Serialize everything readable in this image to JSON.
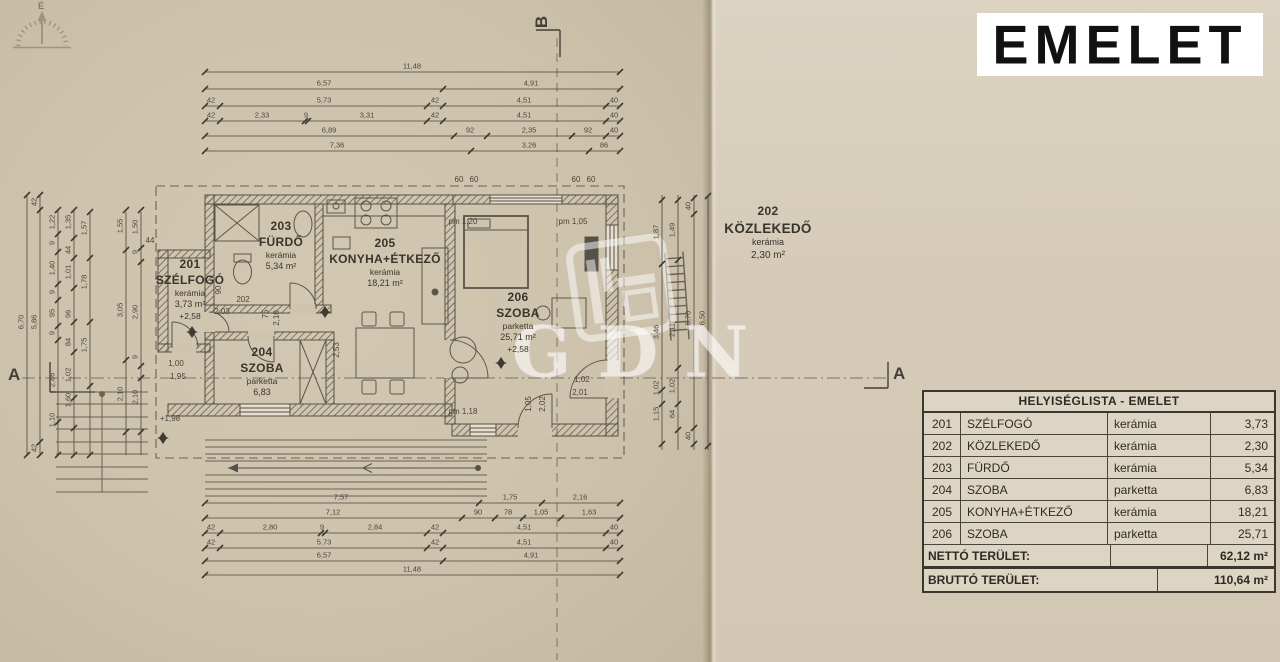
{
  "title_block": "EMELET",
  "compass": {
    "label": "É"
  },
  "section_markers": {
    "a_left": "A",
    "a_right": "A",
    "b_top": "B"
  },
  "watermark": {
    "text": "GDN"
  },
  "colors": {
    "paper_left": "#cdc2ac",
    "paper_right": "#d5cbb8",
    "ink": "#4a443b",
    "wall": "#57514a",
    "table_bg": "#ddd5c4",
    "title_bg": "#ffffff",
    "title_fg": "#111111"
  },
  "rooms": [
    {
      "number": "201",
      "name": "SZÉLFOGÓ",
      "material": "kerámia",
      "area": "3,73 m²",
      "level": "+2,58"
    },
    {
      "number": "202",
      "name": "KÖZLEKEDŐ",
      "material": "kerámia",
      "area": "2,30 m²"
    },
    {
      "number": "203",
      "name": "FÜRDŐ",
      "material": "kerámia",
      "area": "5,34 m²"
    },
    {
      "number": "204",
      "name": "SZOBA",
      "material": "parketta",
      "area": "6,83"
    },
    {
      "number": "205",
      "name": "KONYHA+ÉTKEZŐ",
      "material": "kerámia",
      "area": "18,21 m²"
    },
    {
      "number": "206",
      "name": "SZOBA",
      "material": "parketta",
      "area": "25,71 m²",
      "level": "+2,58"
    }
  ],
  "table": {
    "title": "HELYISÉGLISTA - EMELET",
    "rows": [
      {
        "num": "201",
        "name": "SZÉLFOGÓ",
        "material": "kerámia",
        "area": "3,73"
      },
      {
        "num": "202",
        "name": "KÖZLEKEDŐ",
        "material": "kerámia",
        "area": "2,30"
      },
      {
        "num": "203",
        "name": "FÜRDŐ",
        "material": "kerámia",
        "area": "5,34"
      },
      {
        "num": "204",
        "name": "SZOBA",
        "material": "parketta",
        "area": "6,83"
      },
      {
        "num": "205",
        "name": "KONYHA+ÉTKEZŐ",
        "material": "kerámia",
        "area": "18,21"
      },
      {
        "num": "206",
        "name": "SZOBA",
        "material": "parketta",
        "area": "25,71"
      }
    ],
    "netto_label": "NETTÓ TERÜLET:",
    "netto_value": "62,12 m²",
    "brutto_label": "BRUTTÓ TERÜLET:",
    "brutto_value": "110,64 m²"
  },
  "dims": {
    "top": [
      {
        "y": 72,
        "x1": 205,
        "x2": 620,
        "ticks": [
          205,
          620
        ],
        "labels": [
          {
            "t": "11,48",
            "x": 412
          }
        ]
      },
      {
        "y": 89,
        "x1": 205,
        "x2": 620,
        "ticks": [
          205,
          443,
          620
        ],
        "labels": [
          {
            "t": "6,57",
            "x": 324
          },
          {
            "t": "4,91",
            "x": 531
          }
        ]
      },
      {
        "y": 106,
        "x1": 205,
        "x2": 620,
        "ticks": [
          205,
          220,
          427,
          443,
          606,
          620
        ],
        "labels": [
          {
            "t": "42",
            "x": 211
          },
          {
            "t": "5,73",
            "x": 324
          },
          {
            "t": "42",
            "x": 435
          },
          {
            "t": "4,51",
            "x": 524
          },
          {
            "t": "40",
            "x": 614
          }
        ]
      },
      {
        "y": 121,
        "x1": 205,
        "x2": 620,
        "ticks": [
          205,
          220,
          305,
          308,
          427,
          443,
          606,
          620
        ],
        "labels": [
          {
            "t": "42",
            "x": 211
          },
          {
            "t": "2,33",
            "x": 262
          },
          {
            "t": "9",
            "x": 306
          },
          {
            "t": "3,31",
            "x": 367
          },
          {
            "t": "42",
            "x": 435
          },
          {
            "t": "4,51",
            "x": 524
          },
          {
            "t": "40",
            "x": 614
          }
        ]
      },
      {
        "y": 136,
        "x1": 205,
        "x2": 620,
        "ticks": [
          205,
          454,
          487,
          572,
          606,
          620
        ],
        "labels": [
          {
            "t": "6,89",
            "x": 329
          },
          {
            "t": "92",
            "x": 470
          },
          {
            "t": "2,35",
            "x": 529
          },
          {
            "t": "92",
            "x": 588
          },
          {
            "t": "40",
            "x": 614
          }
        ]
      },
      {
        "y": 151,
        "x1": 205,
        "x2": 620,
        "ticks": [
          205,
          471,
          589,
          620
        ],
        "labels": [
          {
            "t": "7,36",
            "x": 337
          },
          {
            "t": "3,26",
            "x": 529
          },
          {
            "t": "86",
            "x": 604
          }
        ]
      }
    ],
    "bottom": [
      {
        "y": 503,
        "x1": 205,
        "x2": 620,
        "ticks": [
          205,
          479,
          542,
          620
        ],
        "labels": [
          {
            "t": "7,57",
            "x": 341
          },
          {
            "t": "1,75",
            "x": 510
          },
          {
            "t": "2,16",
            "x": 580
          }
        ]
      },
      {
        "y": 518,
        "x1": 205,
        "x2": 620,
        "ticks": [
          205,
          462,
          495,
          523,
          561,
          620
        ],
        "labels": [
          {
            "t": "7,12",
            "x": 333
          },
          {
            "t": "90",
            "x": 478
          },
          {
            "t": "78",
            "x": 508
          },
          {
            "t": "1,05",
            "x": 541
          },
          {
            "t": "1,63",
            "x": 589
          }
        ]
      },
      {
        "y": 533,
        "x1": 205,
        "x2": 620,
        "ticks": [
          205,
          220,
          321,
          325,
          427,
          443,
          606,
          620
        ],
        "labels": [
          {
            "t": "42",
            "x": 211
          },
          {
            "t": "2,80",
            "x": 270
          },
          {
            "t": "9",
            "x": 322
          },
          {
            "t": "2,84",
            "x": 375
          },
          {
            "t": "42",
            "x": 435
          },
          {
            "t": "4,51",
            "x": 524
          },
          {
            "t": "40",
            "x": 614
          }
        ]
      },
      {
        "y": 548,
        "x1": 205,
        "x2": 620,
        "ticks": [
          205,
          220,
          427,
          443,
          606,
          620
        ],
        "labels": [
          {
            "t": "42",
            "x": 211
          },
          {
            "t": "5,73",
            "x": 324
          },
          {
            "t": "42",
            "x": 435
          },
          {
            "t": "4,51",
            "x": 524
          },
          {
            "t": "40",
            "x": 614
          }
        ]
      },
      {
        "y": 561,
        "x1": 205,
        "x2": 620,
        "ticks": [
          205,
          443,
          620
        ],
        "labels": [
          {
            "t": "6,57",
            "x": 324
          },
          {
            "t": "4,91",
            "x": 531
          }
        ]
      },
      {
        "y": 575,
        "x1": 205,
        "x2": 620,
        "ticks": [
          205,
          620
        ],
        "labels": [
          {
            "t": "11,48",
            "x": 412
          }
        ]
      }
    ],
    "left": [
      {
        "x": 27,
        "y1": 195,
        "y2": 455,
        "ticks": [
          195,
          455
        ],
        "labels": [
          {
            "t": "6,70",
            "y": 322
          }
        ]
      },
      {
        "x": 40,
        "y1": 195,
        "y2": 455,
        "ticks": [
          195,
          210,
          442,
          455
        ],
        "labels": [
          {
            "t": "42",
            "y": 202
          },
          {
            "t": "5,86",
            "y": 322
          },
          {
            "t": "42",
            "y": 448
          }
        ]
      },
      {
        "x": 58,
        "y1": 210,
        "y2": 455,
        "ticks": [
          210,
          234,
          252,
          284,
          300,
          326,
          340,
          422,
          455
        ],
        "labels": [
          {
            "t": "1,22",
            "y": 222
          },
          {
            "t": "9",
            "y": 243
          },
          {
            "t": "1,40",
            "y": 268
          },
          {
            "t": "9",
            "y": 292
          },
          {
            "t": "95",
            "y": 313
          },
          {
            "t": "9",
            "y": 333
          },
          {
            "t": "2,86",
            "y": 380
          },
          {
            "t": "1,10",
            "y": 420
          }
        ]
      },
      {
        "x": 74,
        "y1": 210,
        "y2": 455,
        "ticks": [
          210,
          238,
          258,
          288,
          322,
          352,
          398,
          428,
          455
        ],
        "labels": [
          {
            "t": "1,35",
            "y": 222
          },
          {
            "t": "44",
            "y": 250
          },
          {
            "t": "1,01",
            "y": 272
          },
          {
            "t": "96",
            "y": 314
          },
          {
            "t": "84",
            "y": 342
          },
          {
            "t": "1,02",
            "y": 375
          },
          {
            "t": "1,60",
            "y": 400
          }
        ]
      },
      {
        "x": 90,
        "y1": 212,
        "y2": 455,
        "ticks": [
          212,
          258,
          322,
          386,
          455
        ],
        "labels": [
          {
            "t": "1,57",
            "y": 228
          },
          {
            "t": "1,78",
            "y": 282
          },
          {
            "t": "1,75",
            "y": 345
          }
        ]
      },
      {
        "x": 126,
        "y1": 212,
        "y2": 455,
        "ticks": [
          210,
          250,
          360,
          432
        ],
        "labels": [
          {
            "t": "1,55",
            "y": 226
          },
          {
            "t": "3,05",
            "y": 310
          },
          {
            "t": "2,10",
            "y": 394
          }
        ]
      },
      {
        "x": 141,
        "y1": 212,
        "y2": 455,
        "ticks": [
          210,
          248,
          262,
          366,
          378,
          432
        ],
        "labels": [
          {
            "t": "1,50",
            "y": 227
          },
          {
            "t": "9",
            "y": 252
          },
          {
            "t": "2,90",
            "y": 312
          },
          {
            "t": "9",
            "y": 357
          },
          {
            "t": "2,10",
            "y": 397
          }
        ]
      }
    ],
    "right": [
      {
        "x": 662,
        "y1": 195,
        "y2": 450,
        "ticks": [
          200,
          264,
          390,
          404,
          444
        ],
        "labels": [
          {
            "t": "1,87",
            "y": 232
          },
          {
            "t": "3,46",
            "y": 332
          },
          {
            "t": "1,02",
            "y": 388
          },
          {
            "t": "1,15",
            "y": 414
          }
        ]
      },
      {
        "x": 678,
        "y1": 195,
        "y2": 450,
        "ticks": [
          200,
          260,
          368,
          404,
          430
        ],
        "labels": [
          {
            "t": "1,49",
            "y": 230
          },
          {
            "t": "2,11",
            "y": 330
          },
          {
            "t": "1,02",
            "y": 386
          },
          {
            "t": "64",
            "y": 414
          }
        ]
      },
      {
        "x": 694,
        "y1": 195,
        "y2": 450,
        "ticks": [
          198,
          214,
          428,
          444
        ],
        "labels": [
          {
            "t": "40",
            "y": 206
          },
          {
            "t": "5,70",
            "y": 318
          },
          {
            "t": "40",
            "y": 436
          }
        ]
      },
      {
        "x": 708,
        "y1": 195,
        "y2": 450,
        "ticks": [
          196,
          446
        ],
        "labels": [
          {
            "t": "6,50",
            "y": 318
          }
        ]
      }
    ]
  },
  "annotations": [
    {
      "t": "pm 1,20",
      "x": 463,
      "y": 222
    },
    {
      "t": "pm 1,05",
      "x": 573,
      "y": 222
    },
    {
      "t": "pm 1,18",
      "x": 463,
      "y": 412
    },
    {
      "t": "1,02",
      "x": 582,
      "y": 380
    },
    {
      "t": "2,01",
      "x": 580,
      "y": 393
    },
    {
      "t": "1,05",
      "x": 529,
      "y": 404,
      "r": -90
    },
    {
      "t": "2,02",
      "x": 543,
      "y": 404,
      "r": -90
    },
    {
      "t": "202",
      "x": 243,
      "y": 300
    },
    {
      "t": "2,03",
      "x": 222,
      "y": 312
    },
    {
      "t": "+1,98",
      "x": 170,
      "y": 419
    },
    {
      "t": "1,00",
      "x": 176,
      "y": 364
    },
    {
      "t": "1,95",
      "x": 178,
      "y": 377
    },
    {
      "t": "60",
      "x": 459,
      "y": 180
    },
    {
      "t": "60",
      "x": 474,
      "y": 180
    },
    {
      "t": "60",
      "x": 576,
      "y": 180
    },
    {
      "t": "60",
      "x": 591,
      "y": 180
    },
    {
      "t": "2,53",
      "x": 337,
      "y": 350,
      "r": -90
    },
    {
      "t": "75",
      "x": 266,
      "y": 314,
      "r": -90
    },
    {
      "t": "2,10",
      "x": 277,
      "y": 318,
      "r": -90
    },
    {
      "t": "90",
      "x": 219,
      "y": 290,
      "r": -90
    },
    {
      "t": "44",
      "x": 150,
      "y": 241
    }
  ]
}
